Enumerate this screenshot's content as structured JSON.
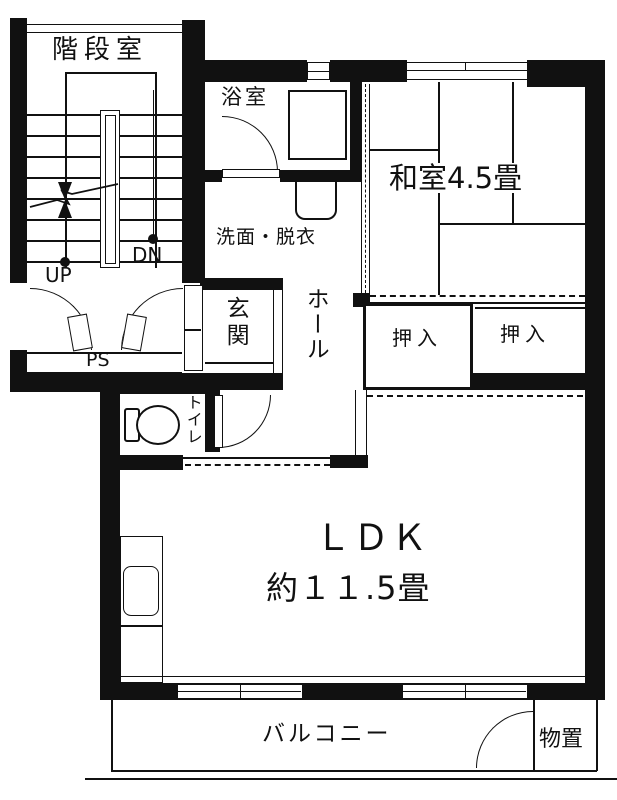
{
  "title": "apartment-floor-plan",
  "colors": {
    "wall": "#111111",
    "background": "#ffffff",
    "line": "#111111"
  },
  "rooms": {
    "stairwell": {
      "label": "階段室"
    },
    "bathroom": {
      "label": "浴室"
    },
    "washroom": {
      "label": "洗面・脱衣"
    },
    "entrance": {
      "label": "玄関"
    },
    "hall": {
      "label": "ホール"
    },
    "japanese_room": {
      "label": "和室4.5畳"
    },
    "closet_left": {
      "label": "押入"
    },
    "closet_right": {
      "label": "押入"
    },
    "toilet": {
      "label": "トイレ"
    },
    "ldk": {
      "label": "ＬＤＫ",
      "size_label": "約１１.5畳"
    },
    "balcony": {
      "label": "バルコニー"
    },
    "storage": {
      "label": "物置"
    }
  },
  "stairs": {
    "up_label": "UP",
    "down_label": "DN"
  },
  "pipe_space": {
    "label": "PS"
  }
}
